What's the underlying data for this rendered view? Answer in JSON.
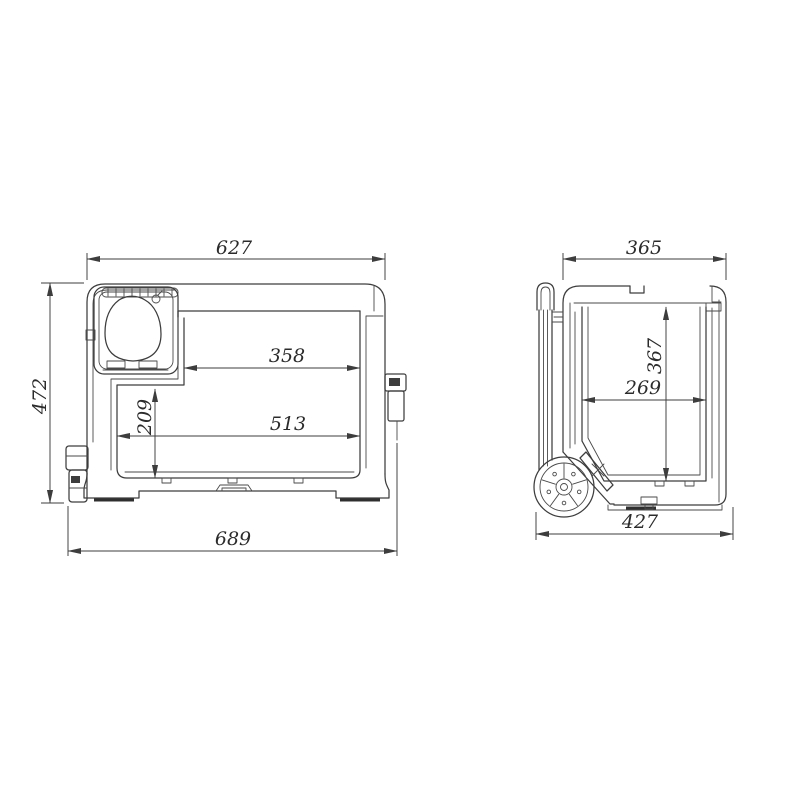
{
  "diagram": {
    "background_color": "#ffffff",
    "line_color": "#3d3d3d",
    "text_color": "#2b2b2b",
    "front_view": {
      "width_top": "627",
      "height_overall": "472",
      "width_inner_upper": "358",
      "height_inner_lower": "209",
      "width_inner_lower": "513",
      "width_overall": "689"
    },
    "side_view": {
      "depth_top": "365",
      "height_inner": "367",
      "depth_inner": "269",
      "depth_overall": "427"
    }
  }
}
